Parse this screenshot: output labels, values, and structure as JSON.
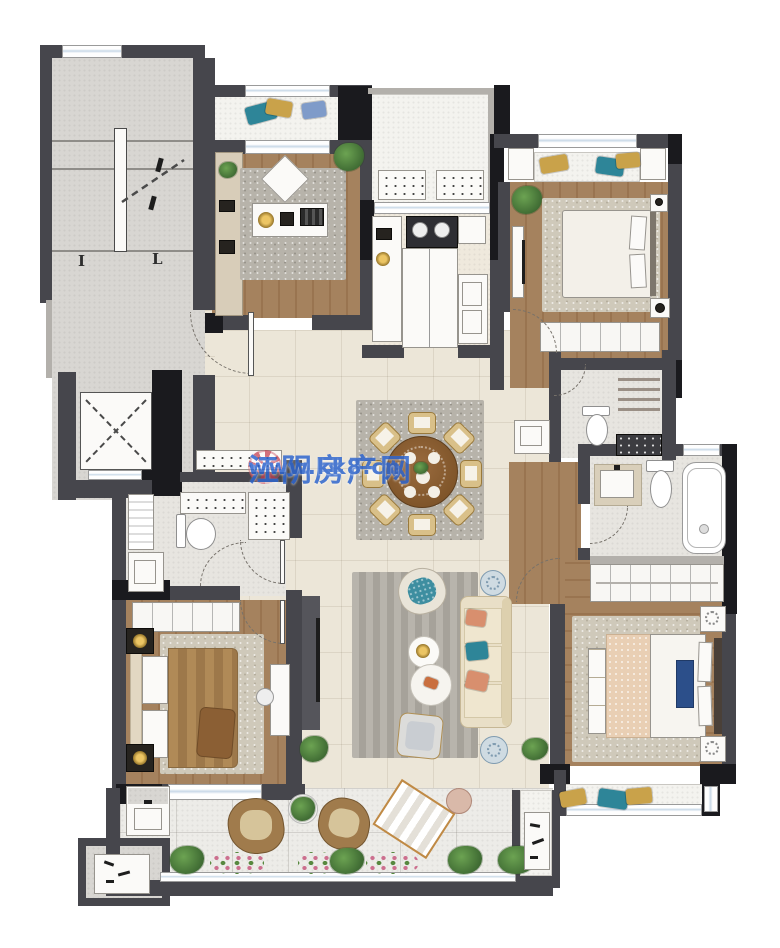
{
  "watermark": {
    "site_name": "江阴房产网",
    "url": "www.kk8.cn",
    "logo": "flower-icon",
    "text_color": "#2f66cf",
    "logo_color": "#c23b4e"
  },
  "stairwell": {
    "mark_left": "I",
    "mark_right": "L"
  },
  "colors": {
    "wall": "#46464c",
    "wall-dark": "#1a1a1e",
    "concrete": "#d8d6d2",
    "wood": "#a5825e",
    "wood-dark": "#997450",
    "tile": "#ece6d8",
    "balcony": "#f4f3ef",
    "rug-gray": "#b7b3aa",
    "rug-beige": "#cfc9ba",
    "sofa": "#e9dfc7",
    "teal": "#2e8598",
    "peach": "#d88f6e",
    "gold": "#c9a24a",
    "plant-green": "#4e7d3a",
    "wm-blue": "#2f66cf",
    "wm-red": "#c23b4e"
  }
}
